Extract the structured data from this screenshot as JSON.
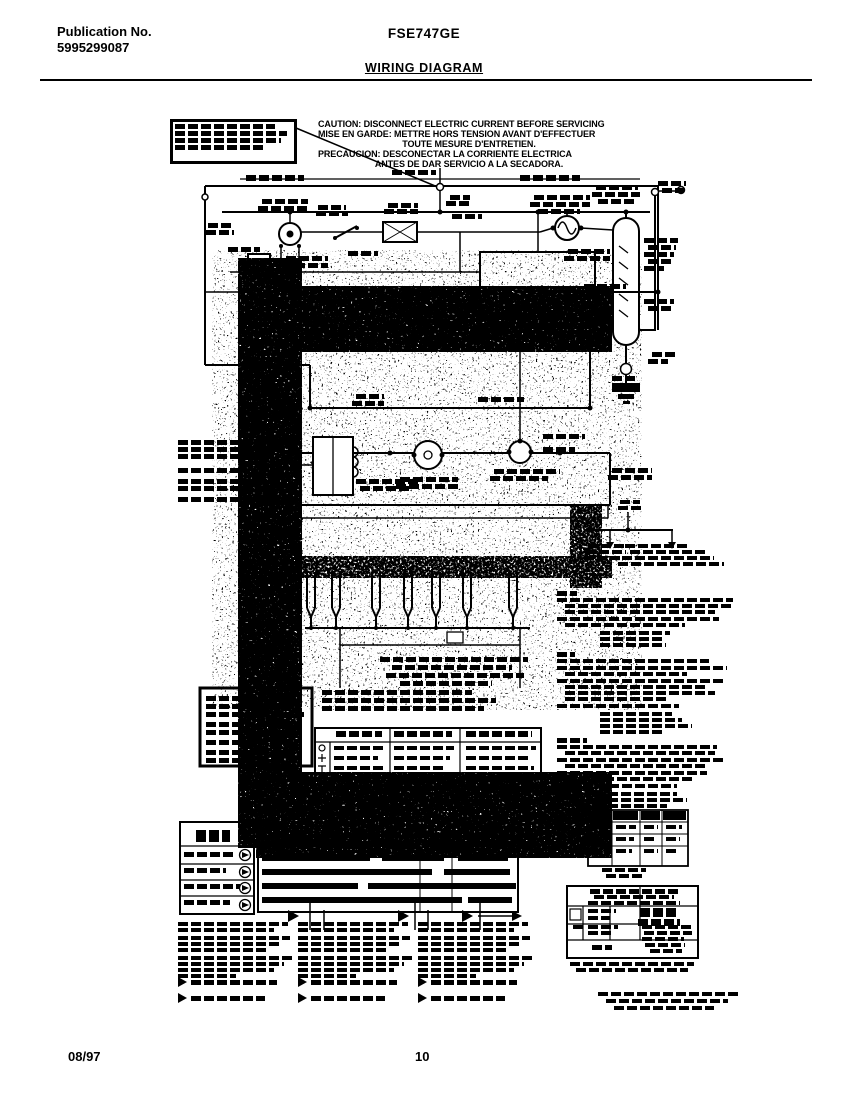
{
  "header": {
    "publication_label": "Publication No.",
    "publication_number": "5995299087",
    "model": "FSE747GE",
    "title": "WIRING DIAGRAM"
  },
  "caution": {
    "line1": "CAUTION: DISCONNECT ELECTRIC CURRENT BEFORE SERVICING",
    "line2": "MISE EN GARDE: METTRE HORS TENSION AVANT D'EFFECTUER",
    "line3": "TOUTE MESURE D'ENTRETIEN.",
    "line4": "PRECAUCION: DESCONECTAR LA CORRIENTE ELECTRICA",
    "line5": "ANTES DE DAR SERVICIO A LA SECADORA."
  },
  "footer": {
    "date": "08/97",
    "page_number": "10"
  }
}
